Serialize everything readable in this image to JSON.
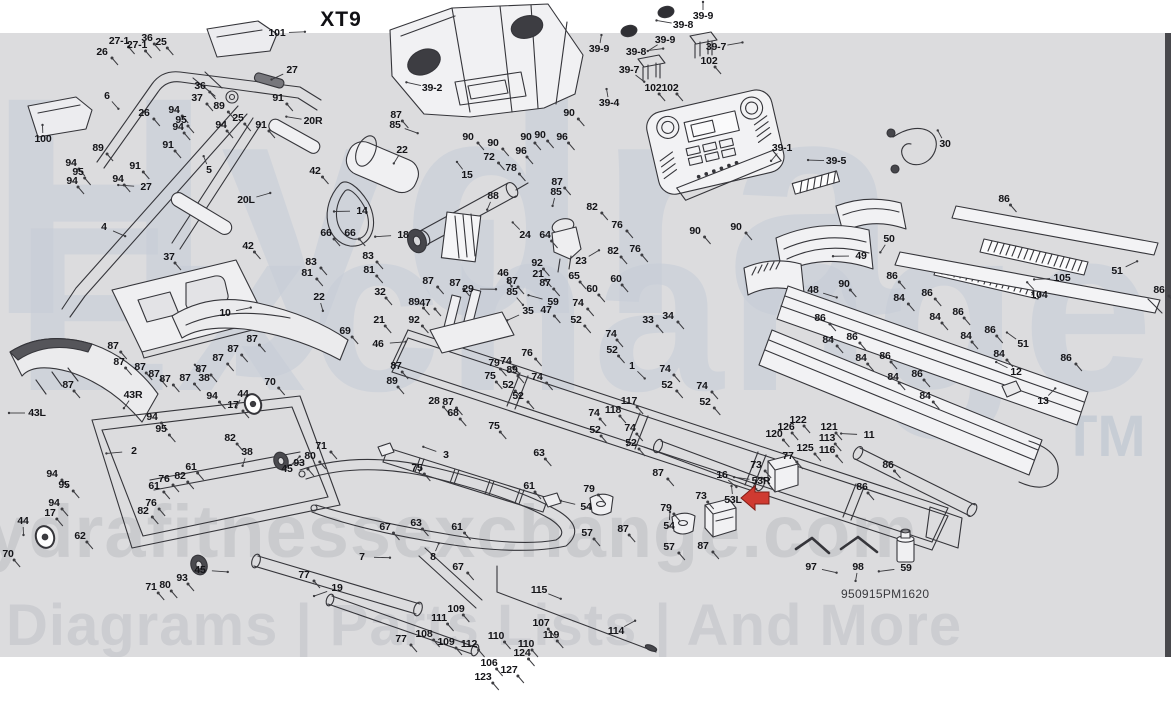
{
  "title": "XT9",
  "part_number": "950915PM1620",
  "watermark": {
    "line1": "Hydra",
    "line2": "Exchange",
    "trademark": "TM",
    "site": "hydrafitnessexchange.com",
    "tagline": "Diagrams | Parts Lists | And More"
  },
  "colors": {
    "canvas": "#dcdcde",
    "line": "#35353a",
    "label": "#141418",
    "arrow": "#cf3a31",
    "arrow_outline": "#801d15",
    "watermark": "#c6cdd8"
  },
  "red_arrow": {
    "points_to": "53L",
    "x": 755,
    "y": 498
  },
  "labels": [
    [
      "26",
      102,
      52
    ],
    [
      "27-1",
      119,
      41
    ],
    [
      "27-1",
      137,
      45
    ],
    [
      "36",
      147,
      38
    ],
    [
      "25",
      161,
      42
    ],
    [
      "101",
      277,
      33
    ],
    [
      "6",
      107,
      96
    ],
    [
      "27",
      292,
      70
    ],
    [
      "91",
      278,
      98
    ],
    [
      "36",
      200,
      86
    ],
    [
      "37",
      197,
      98
    ],
    [
      "89",
      219,
      106
    ],
    [
      "94",
      174,
      110
    ],
    [
      "95",
      181,
      120
    ],
    [
      "94",
      178,
      127
    ],
    [
      "94",
      221,
      125
    ],
    [
      "25",
      238,
      118
    ],
    [
      "91",
      261,
      125
    ],
    [
      "20R",
      313,
      121
    ],
    [
      "100",
      43,
      139
    ],
    [
      "26",
      144,
      113
    ],
    [
      "89",
      98,
      148
    ],
    [
      "94",
      71,
      163
    ],
    [
      "95",
      78,
      172
    ],
    [
      "94",
      72,
      181
    ],
    [
      "94",
      118,
      179
    ],
    [
      "91",
      168,
      145
    ],
    [
      "91",
      135,
      166
    ],
    [
      "27",
      146,
      187
    ],
    [
      "5",
      209,
      170
    ],
    [
      "20L",
      246,
      200
    ],
    [
      "4",
      104,
      227
    ],
    [
      "42",
      315,
      171
    ],
    [
      "42",
      248,
      246
    ],
    [
      "37",
      169,
      257
    ],
    [
      "87",
      396,
      115
    ],
    [
      "85",
      395,
      125
    ],
    [
      "22",
      402,
      150
    ],
    [
      "14",
      362,
      211
    ],
    [
      "15",
      467,
      175
    ],
    [
      "72",
      489,
      157
    ],
    [
      "78",
      511,
      168
    ],
    [
      "88",
      493,
      196
    ],
    [
      "18",
      403,
      235
    ],
    [
      "24",
      525,
      235
    ],
    [
      "64",
      545,
      235
    ],
    [
      "87",
      557,
      182
    ],
    [
      "85",
      556,
      192
    ],
    [
      "82",
      592,
      207
    ],
    [
      "76",
      617,
      225
    ],
    [
      "23",
      581,
      261
    ],
    [
      "82",
      613,
      251
    ],
    [
      "76",
      635,
      249
    ],
    [
      "65",
      574,
      276
    ],
    [
      "60",
      616,
      279
    ],
    [
      "60",
      592,
      289
    ],
    [
      "66",
      326,
      233
    ],
    [
      "66",
      350,
      233
    ],
    [
      "83",
      311,
      262
    ],
    [
      "81",
      307,
      273
    ],
    [
      "83",
      368,
      256
    ],
    [
      "81",
      369,
      270
    ],
    [
      "22",
      319,
      297
    ],
    [
      "32",
      380,
      292
    ],
    [
      "21",
      379,
      320
    ],
    [
      "69",
      345,
      331
    ],
    [
      "92",
      414,
      320
    ],
    [
      "89",
      414,
      302
    ],
    [
      "47",
      425,
      303
    ],
    [
      "87",
      428,
      281
    ],
    [
      "87",
      455,
      283
    ],
    [
      "29",
      468,
      289
    ],
    [
      "46",
      503,
      273
    ],
    [
      "87",
      512,
      281
    ],
    [
      "92",
      537,
      263
    ],
    [
      "21",
      538,
      274
    ],
    [
      "87",
      545,
      283
    ],
    [
      "85",
      512,
      292
    ],
    [
      "35",
      528,
      311
    ],
    [
      "59",
      553,
      302
    ],
    [
      "47",
      546,
      310
    ],
    [
      "46",
      378,
      344
    ],
    [
      "87",
      396,
      366
    ],
    [
      "89",
      392,
      381
    ],
    [
      "39-2",
      432,
      88
    ],
    [
      "39-9",
      599,
      49
    ],
    [
      "39-8",
      636,
      52
    ],
    [
      "39-7",
      629,
      70
    ],
    [
      "39-9",
      665,
      40
    ],
    [
      "39-8",
      683,
      25
    ],
    [
      "39-9",
      703,
      16
    ],
    [
      "39-7",
      716,
      47
    ],
    [
      "102",
      709,
      61
    ],
    [
      "102",
      653,
      88
    ],
    [
      "102",
      670,
      88
    ],
    [
      "39-4",
      609,
      103
    ],
    [
      "90",
      569,
      113
    ],
    [
      "90",
      468,
      137
    ],
    [
      "90",
      493,
      143
    ],
    [
      "90",
      526,
      137
    ],
    [
      "90",
      540,
      135
    ],
    [
      "96",
      562,
      137
    ],
    [
      "96",
      521,
      151
    ],
    [
      "39-1",
      782,
      148
    ],
    [
      "39-5",
      836,
      161
    ],
    [
      "30",
      945,
      144
    ],
    [
      "90",
      695,
      231
    ],
    [
      "90",
      736,
      227
    ],
    [
      "50",
      889,
      239
    ],
    [
      "49",
      861,
      256
    ],
    [
      "86",
      892,
      276
    ],
    [
      "90",
      844,
      284
    ],
    [
      "48",
      813,
      290
    ],
    [
      "86",
      1004,
      199
    ],
    [
      "105",
      1062,
      278
    ],
    [
      "104",
      1039,
      295
    ],
    [
      "51",
      1117,
      271
    ],
    [
      "86",
      1159,
      290
    ],
    [
      "84",
      899,
      298
    ],
    [
      "86",
      927,
      293
    ],
    [
      "84",
      935,
      317
    ],
    [
      "86",
      958,
      312
    ],
    [
      "84",
      966,
      336
    ],
    [
      "86",
      990,
      330
    ],
    [
      "84",
      999,
      354
    ],
    [
      "51",
      1023,
      344
    ],
    [
      "86",
      1066,
      358
    ],
    [
      "86",
      820,
      318
    ],
    [
      "84",
      828,
      340
    ],
    [
      "86",
      852,
      337
    ],
    [
      "84",
      861,
      358
    ],
    [
      "86",
      885,
      356
    ],
    [
      "84",
      893,
      377
    ],
    [
      "86",
      917,
      374
    ],
    [
      "84",
      925,
      396
    ],
    [
      "12",
      1016,
      372
    ],
    [
      "13",
      1043,
      401
    ],
    [
      "74",
      578,
      303
    ],
    [
      "52",
      576,
      320
    ],
    [
      "74",
      506,
      361
    ],
    [
      "79",
      494,
      363
    ],
    [
      "89",
      512,
      370
    ],
    [
      "75",
      490,
      376
    ],
    [
      "52",
      508,
      385
    ],
    [
      "76",
      527,
      353
    ],
    [
      "74",
      537,
      377
    ],
    [
      "52",
      518,
      396
    ],
    [
      "28",
      434,
      401
    ],
    [
      "87",
      448,
      402
    ],
    [
      "68",
      453,
      413
    ],
    [
      "75",
      494,
      426
    ],
    [
      "74",
      611,
      334
    ],
    [
      "52",
      612,
      350
    ],
    [
      "1",
      632,
      366
    ],
    [
      "74",
      665,
      369
    ],
    [
      "52",
      667,
      385
    ],
    [
      "74",
      702,
      386
    ],
    [
      "52",
      705,
      402
    ],
    [
      "117",
      629,
      401
    ],
    [
      "118",
      613,
      410
    ],
    [
      "74",
      594,
      413
    ],
    [
      "52",
      595,
      430
    ],
    [
      "74",
      630,
      428
    ],
    [
      "52",
      631,
      443
    ],
    [
      "33",
      648,
      320
    ],
    [
      "34",
      668,
      316
    ],
    [
      "87",
      658,
      473
    ],
    [
      "10",
      225,
      313
    ],
    [
      "87",
      113,
      346
    ],
    [
      "87",
      119,
      362
    ],
    [
      "87",
      68,
      385
    ],
    [
      "87",
      140,
      367
    ],
    [
      "87",
      154,
      374
    ],
    [
      "87",
      165,
      379
    ],
    [
      "87",
      185,
      378
    ],
    [
      "87",
      201,
      369
    ],
    [
      "87",
      218,
      358
    ],
    [
      "87",
      233,
      349
    ],
    [
      "87",
      252,
      339
    ],
    [
      "43R",
      133,
      395
    ],
    [
      "43L",
      37,
      413
    ],
    [
      "38",
      204,
      378
    ],
    [
      "94",
      212,
      396
    ],
    [
      "70",
      270,
      382
    ],
    [
      "44",
      243,
      394
    ],
    [
      "17",
      233,
      405
    ],
    [
      "94",
      152,
      417
    ],
    [
      "95",
      161,
      429
    ],
    [
      "82",
      230,
      438
    ],
    [
      "38",
      247,
      452
    ],
    [
      "2",
      134,
      451
    ],
    [
      "61",
      191,
      467
    ],
    [
      "82",
      180,
      476
    ],
    [
      "76",
      164,
      479
    ],
    [
      "61",
      154,
      486
    ],
    [
      "94",
      52,
      474
    ],
    [
      "95",
      64,
      485
    ],
    [
      "94",
      54,
      503
    ],
    [
      "17",
      50,
      513
    ],
    [
      "44",
      23,
      521
    ],
    [
      "70",
      8,
      554
    ],
    [
      "62",
      80,
      536
    ],
    [
      "76",
      151,
      503
    ],
    [
      "82",
      143,
      511
    ],
    [
      "71",
      321,
      446
    ],
    [
      "80",
      310,
      456
    ],
    [
      "93",
      299,
      463
    ],
    [
      "45",
      287,
      469
    ],
    [
      "45",
      200,
      570
    ],
    [
      "93",
      182,
      578
    ],
    [
      "80",
      165,
      585
    ],
    [
      "71",
      151,
      587
    ],
    [
      "67",
      385,
      527
    ],
    [
      "7",
      362,
      557
    ],
    [
      "77",
      304,
      575
    ],
    [
      "19",
      337,
      588
    ],
    [
      "3",
      446,
      455
    ],
    [
      "75",
      417,
      468
    ],
    [
      "63",
      539,
      453
    ],
    [
      "61",
      529,
      486
    ],
    [
      "63",
      416,
      523
    ],
    [
      "61",
      457,
      527
    ],
    [
      "8",
      433,
      557
    ],
    [
      "67",
      458,
      567
    ],
    [
      "77",
      401,
      639
    ],
    [
      "79",
      589,
      489
    ],
    [
      "54",
      586,
      507
    ],
    [
      "57",
      587,
      533
    ],
    [
      "87",
      623,
      529
    ],
    [
      "16",
      722,
      475
    ],
    [
      "73",
      701,
      496
    ],
    [
      "79",
      666,
      508
    ],
    [
      "54",
      669,
      526
    ],
    [
      "57",
      669,
      547
    ],
    [
      "87",
      703,
      546
    ],
    [
      "73",
      756,
      465
    ],
    [
      "53R",
      761,
      481
    ],
    [
      "53L",
      733,
      500
    ],
    [
      "122",
      798,
      420
    ],
    [
      "126",
      786,
      427
    ],
    [
      "121",
      829,
      427
    ],
    [
      "113",
      827,
      438
    ],
    [
      "120",
      774,
      434
    ],
    [
      "125",
      805,
      448
    ],
    [
      "116",
      827,
      450
    ],
    [
      "77",
      788,
      456
    ],
    [
      "11",
      869,
      435
    ],
    [
      "86",
      888,
      465
    ],
    [
      "86",
      862,
      487
    ],
    [
      "115",
      539,
      590
    ],
    [
      "109",
      456,
      609
    ],
    [
      "111",
      439,
      618
    ],
    [
      "108",
      424,
      634
    ],
    [
      "109",
      446,
      642
    ],
    [
      "112",
      469,
      644
    ],
    [
      "110",
      496,
      636
    ],
    [
      "107",
      541,
      623
    ],
    [
      "119",
      551,
      635
    ],
    [
      "110",
      526,
      644
    ],
    [
      "124",
      522,
      653
    ],
    [
      "106",
      489,
      663
    ],
    [
      "127",
      509,
      670
    ],
    [
      "123",
      483,
      677
    ],
    [
      "114",
      616,
      631
    ],
    [
      "97",
      811,
      567
    ],
    [
      "98",
      858,
      567
    ],
    [
      "59",
      906,
      568
    ]
  ]
}
